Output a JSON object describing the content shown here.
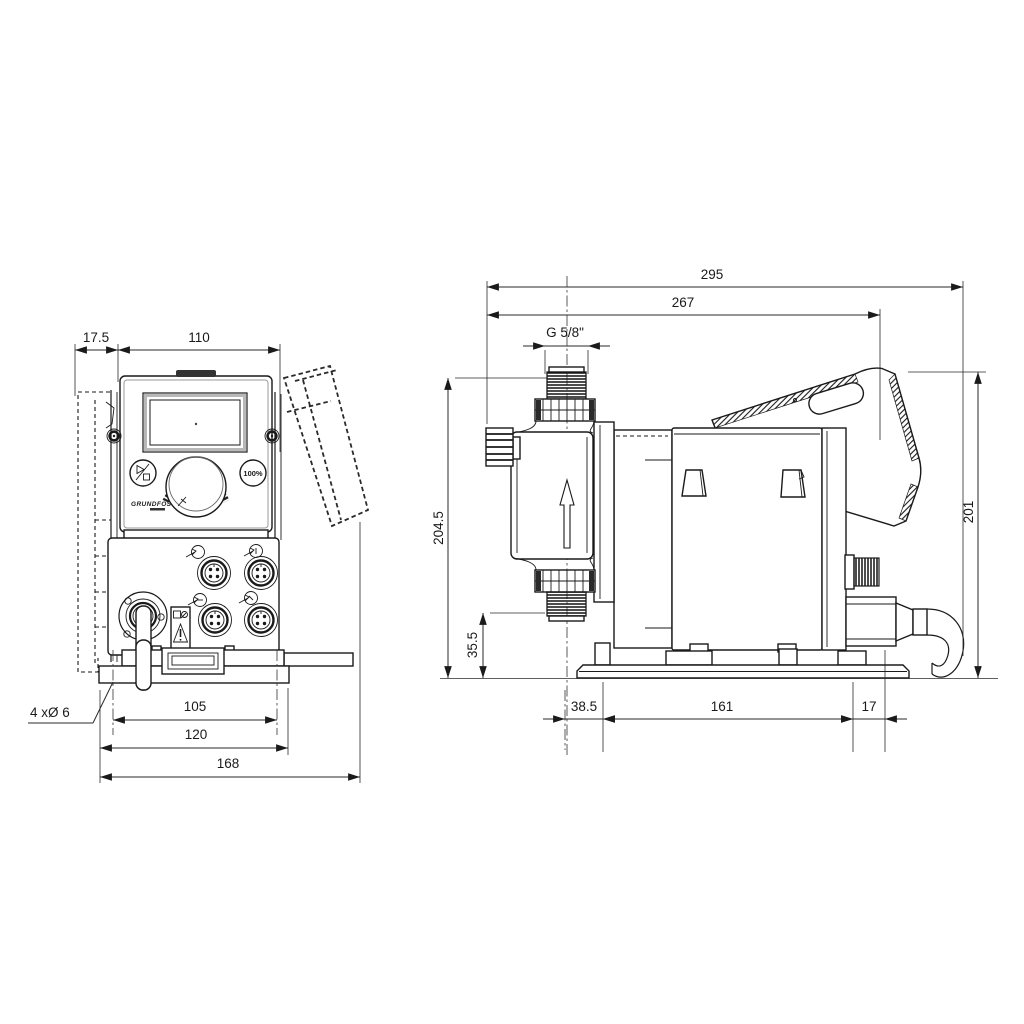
{
  "title": "Dosing pump dimensional drawing",
  "colors": {
    "background": "#ffffff",
    "line": "#1a1a1a",
    "dimension": "#2a2a2a"
  },
  "front_view": {
    "dims": {
      "offset_top": "17.5",
      "width_top": "110",
      "hole_callout": "4 xØ 6",
      "hole_spacing": "105",
      "foot_width": "120",
      "overall_width": "168"
    },
    "panel": {
      "logo": "GRUNDFOS",
      "button_max": "100%"
    }
  },
  "side_view": {
    "dims": {
      "overall_depth": "295",
      "depth_to_cover": "267",
      "thread": "G 5/8\"",
      "overall_height": "204.5",
      "connection_height": "35.5",
      "back_height": "201",
      "front_overhang": "38.5",
      "plate_depth": "161",
      "back_overhang": "17"
    }
  }
}
